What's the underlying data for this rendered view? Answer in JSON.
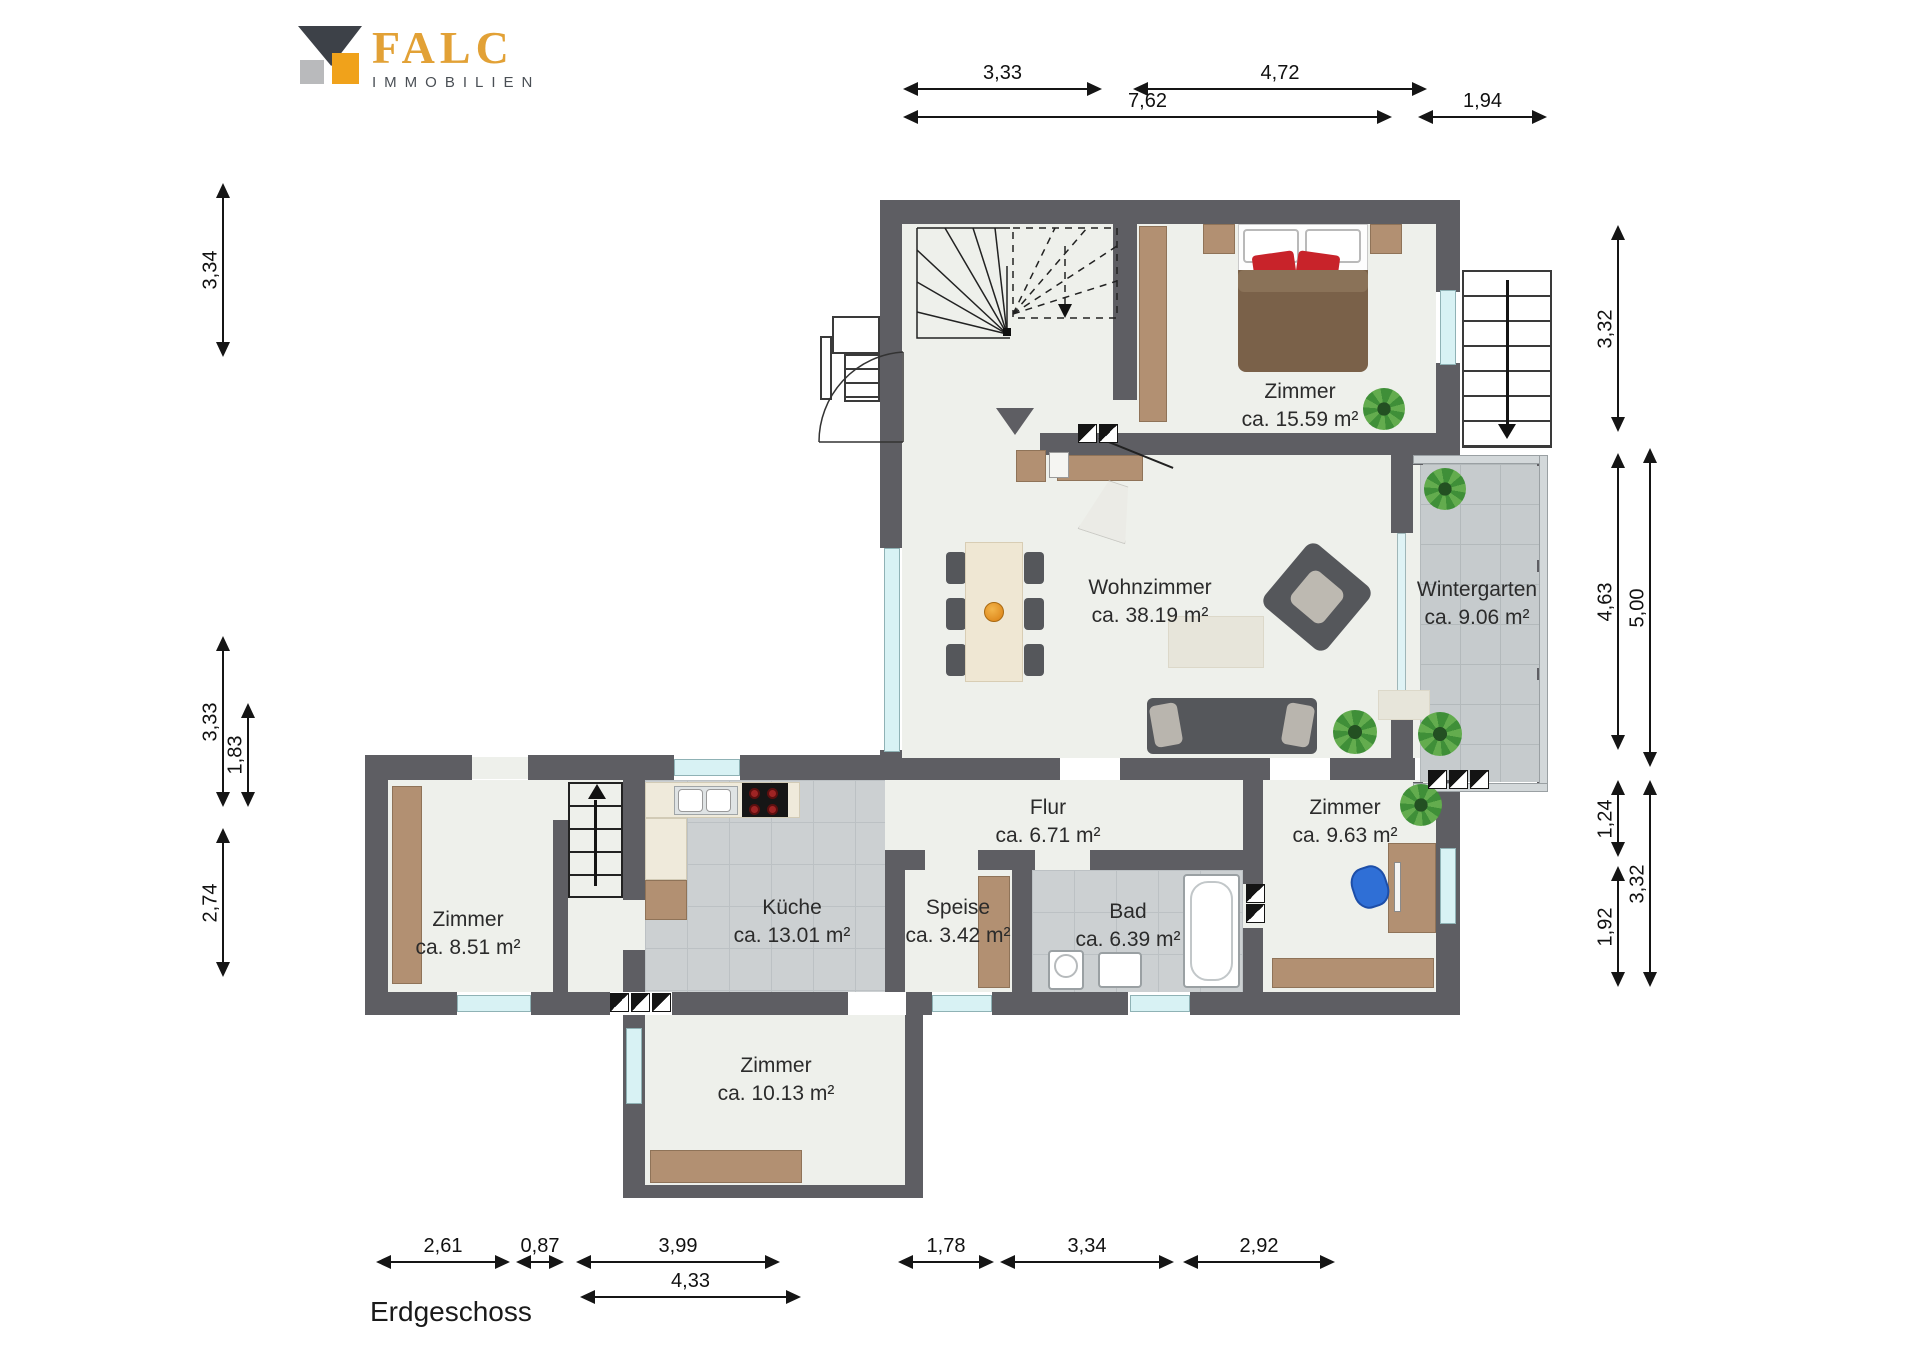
{
  "logo": {
    "brand": "FALC",
    "subtitle": "IMMOBILIEN"
  },
  "floor_label": "Erdgeschoss",
  "rooms": [
    {
      "name": "Zimmer",
      "area": "ca. 15.59 m²",
      "cx": 1300,
      "cy": 378
    },
    {
      "name": "Wohnzimmer",
      "area": "ca. 38.19 m²",
      "cx": 1150,
      "cy": 574
    },
    {
      "name": "Wintergarten",
      "area": "ca. 9.06 m²",
      "cx": 1477,
      "cy": 576
    },
    {
      "name": "Flur",
      "area": "ca. 6.71 m²",
      "cx": 1048,
      "cy": 794
    },
    {
      "name": "Zimmer",
      "area": "ca. 9.63 m²",
      "cx": 1345,
      "cy": 794
    },
    {
      "name": "Zimmer",
      "area": "ca. 8.51 m²",
      "cx": 468,
      "cy": 906
    },
    {
      "name": "Küche",
      "area": "ca. 13.01 m²",
      "cx": 792,
      "cy": 894
    },
    {
      "name": "Speise",
      "area": "ca. 3.42 m²",
      "cx": 958,
      "cy": 894
    },
    {
      "name": "Bad",
      "area": "ca. 6.39 m²",
      "cx": 1128,
      "cy": 898
    },
    {
      "name": "Zimmer",
      "area": "ca. 10.13 m²",
      "cx": 776,
      "cy": 1052
    }
  ],
  "dimensions": {
    "horizontal": [
      {
        "label": "3,33",
        "x": 905,
        "y": 88,
        "len": 195
      },
      {
        "label": "4,72",
        "x": 1135,
        "y": 88,
        "len": 290
      },
      {
        "label": "7,62",
        "x": 905,
        "y": 116,
        "len": 485
      },
      {
        "label": "1,94",
        "x": 1420,
        "y": 116,
        "len": 125
      },
      {
        "label": "2,61",
        "x": 378,
        "y": 1261,
        "len": 130
      },
      {
        "label": "0,87",
        "x": 518,
        "y": 1261,
        "len": 44
      },
      {
        "label": "3,99",
        "x": 578,
        "y": 1261,
        "len": 200
      },
      {
        "label": "1,78",
        "x": 900,
        "y": 1261,
        "len": 92
      },
      {
        "label": "3,34",
        "x": 1002,
        "y": 1261,
        "len": 170
      },
      {
        "label": "2,92",
        "x": 1185,
        "y": 1261,
        "len": 148
      },
      {
        "label": "4,33",
        "x": 582,
        "y": 1296,
        "len": 217
      }
    ],
    "vertical": [
      {
        "label": "3,34",
        "x": 222,
        "y": 185,
        "len": 170
      },
      {
        "label": "3,33",
        "x": 222,
        "y": 638,
        "len": 167
      },
      {
        "label": "1,83",
        "x": 247,
        "y": 705,
        "len": 100
      },
      {
        "label": "2,74",
        "x": 222,
        "y": 830,
        "len": 145
      },
      {
        "label": "3,32",
        "x": 1617,
        "y": 227,
        "len": 203
      },
      {
        "label": "4,63",
        "x": 1617,
        "y": 455,
        "len": 293
      },
      {
        "label": "5,00",
        "x": 1649,
        "y": 450,
        "len": 315
      },
      {
        "label": "1,24",
        "x": 1617,
        "y": 782,
        "len": 73
      },
      {
        "label": "3,32",
        "x": 1649,
        "y": 782,
        "len": 203
      },
      {
        "label": "1,92",
        "x": 1617,
        "y": 868,
        "len": 117
      }
    ]
  },
  "colors": {
    "wall": "#5e5e63",
    "floor": "#eef0eb",
    "tile": "#ccd0d2",
    "wood": "#b29072",
    "brand_orange": "#f0a21b",
    "brand_gray": "#3d4148"
  }
}
